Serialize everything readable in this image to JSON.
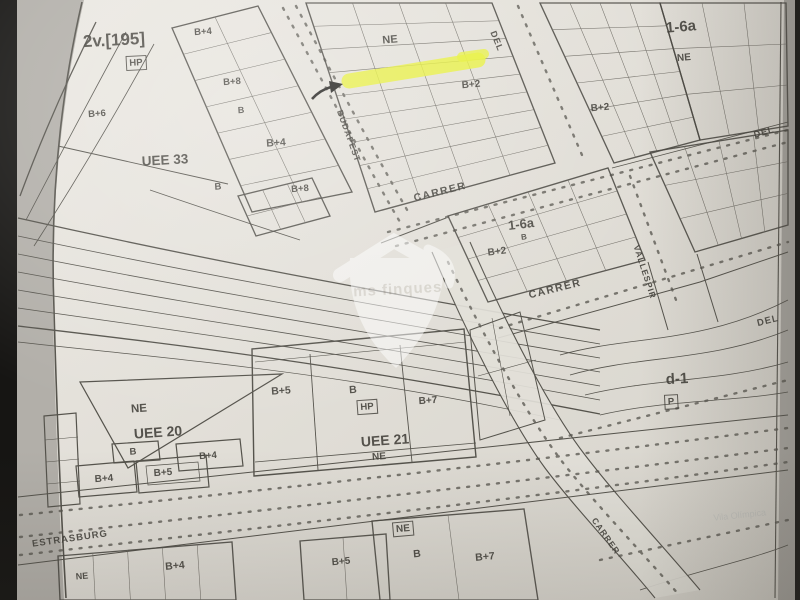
{
  "map": {
    "paper_color": "#e6e3dc",
    "ink_color": "#45433d",
    "highlight": {
      "color": "#e9f23c"
    },
    "watermark": {
      "text": "ms finques"
    },
    "faint_label": {
      "text": "Vila Olímpica"
    },
    "labels": [
      {
        "id": "zone-2v-195",
        "text": "2v.[195]",
        "x": 114,
        "y": 40,
        "rot": -3,
        "size": 17,
        "w": 700
      },
      {
        "id": "hp-box-nw",
        "text": "HP",
        "x": 136,
        "y": 63,
        "rot": -3,
        "size": 9.5,
        "w": 700,
        "boxed": true
      },
      {
        "id": "b4-nw-1",
        "text": "B+4",
        "x": 203,
        "y": 32,
        "rot": -4,
        "size": 9.5,
        "w": 700
      },
      {
        "id": "b8-nw",
        "text": "B+8",
        "x": 232,
        "y": 82,
        "rot": -4,
        "size": 9.5,
        "w": 700
      },
      {
        "id": "b6-w",
        "text": "B+6",
        "x": 97,
        "y": 114,
        "rot": -4,
        "size": 9.5,
        "w": 700
      },
      {
        "id": "b-nw-1",
        "text": "B",
        "x": 241,
        "y": 110,
        "rot": -4,
        "size": 9,
        "w": 700
      },
      {
        "id": "b4-nw-2",
        "text": "B+4",
        "x": 276,
        "y": 143,
        "rot": -4,
        "size": 10.5,
        "w": 700
      },
      {
        "id": "b-nw-2",
        "text": "B",
        "x": 218,
        "y": 187,
        "rot": -4,
        "size": 9.5,
        "w": 700
      },
      {
        "id": "b8-nw-2",
        "text": "B+8",
        "x": 300,
        "y": 189,
        "rot": -4,
        "size": 9.5,
        "w": 700
      },
      {
        "id": "zone-uee-33",
        "text": "UEE 33",
        "x": 165,
        "y": 160,
        "rot": -3,
        "size": 13.5,
        "w": 700
      },
      {
        "id": "ne-top-center",
        "text": "NE",
        "x": 390,
        "y": 40,
        "rot": -5,
        "size": 11,
        "w": 700
      },
      {
        "id": "street-del-top",
        "text": "DEL",
        "x": 497,
        "y": 41,
        "rot": 68,
        "size": 9,
        "w": 700,
        "ls": 1
      },
      {
        "id": "b2-top-center",
        "text": "B+2",
        "x": 471,
        "y": 85,
        "rot": -5,
        "size": 10,
        "w": 700
      },
      {
        "id": "street-budapest",
        "text": "BUDAPEST",
        "x": 349,
        "y": 136,
        "rot": 70,
        "size": 8.5,
        "w": 600,
        "ls": 1
      },
      {
        "id": "zone-1-6a-ne",
        "text": "1-6a",
        "x": 681,
        "y": 27,
        "rot": -5,
        "size": 15,
        "w": 700
      },
      {
        "id": "ne-top-right",
        "text": "NE",
        "x": 684,
        "y": 58,
        "rot": -5,
        "size": 10,
        "w": 700
      },
      {
        "id": "b2-top-right",
        "text": "B+2",
        "x": 600,
        "y": 108,
        "rot": -5,
        "size": 10,
        "w": 700
      },
      {
        "id": "street-del-topright",
        "text": "DEL",
        "x": 764,
        "y": 132,
        "rot": -16,
        "size": 9,
        "w": 700,
        "ls": 1
      },
      {
        "id": "street-carrer-1",
        "text": "CARRER",
        "x": 440,
        "y": 192,
        "rot": -14,
        "size": 10.5,
        "w": 700,
        "ls": 1.5
      },
      {
        "id": "zone-1-6a-center",
        "text": "1-6a",
        "x": 521,
        "y": 224,
        "rot": -7,
        "size": 13,
        "w": 700
      },
      {
        "id": "b-center",
        "text": "B",
        "x": 524,
        "y": 237,
        "rot": -7,
        "size": 8,
        "w": 700
      },
      {
        "id": "b2-center",
        "text": "B+2",
        "x": 497,
        "y": 252,
        "rot": -7,
        "size": 10,
        "w": 700
      },
      {
        "id": "street-carrer-2",
        "text": "CARRER",
        "x": 555,
        "y": 289,
        "rot": -14,
        "size": 10.5,
        "w": 700,
        "ls": 1.5
      },
      {
        "id": "street-vallespir",
        "text": "VALLESPIR",
        "x": 645,
        "y": 272,
        "rot": 72,
        "size": 8.5,
        "w": 600,
        "ls": 1
      },
      {
        "id": "street-del-right",
        "text": "DEL",
        "x": 768,
        "y": 321,
        "rot": -14,
        "size": 9.5,
        "w": 700,
        "ls": 1
      },
      {
        "id": "ne-uee20",
        "text": "NE",
        "x": 139,
        "y": 409,
        "rot": -4,
        "size": 11.5,
        "w": 700
      },
      {
        "id": "zone-uee-20",
        "text": "UEE 20",
        "x": 158,
        "y": 432,
        "rot": -4,
        "size": 14,
        "w": 700
      },
      {
        "id": "b-uee20",
        "text": "B",
        "x": 133,
        "y": 452,
        "rot": -4,
        "size": 9.5,
        "w": 700
      },
      {
        "id": "b4-uee20-1",
        "text": "B+4",
        "x": 208,
        "y": 456,
        "rot": -4,
        "size": 9.5,
        "w": 700
      },
      {
        "id": "b4-uee20-2",
        "text": "B+4",
        "x": 104,
        "y": 479,
        "rot": -4,
        "size": 10,
        "w": 700
      },
      {
        "id": "b5-uee20",
        "text": "B+5",
        "x": 163,
        "y": 473,
        "rot": -4,
        "size": 10,
        "w": 700
      },
      {
        "id": "b5-uee21",
        "text": "B+5",
        "x": 281,
        "y": 391,
        "rot": -4,
        "size": 10.5,
        "w": 700
      },
      {
        "id": "b-uee21",
        "text": "B",
        "x": 353,
        "y": 390,
        "rot": -4,
        "size": 10.5,
        "w": 700
      },
      {
        "id": "hp-box-uee21",
        "text": "HP",
        "x": 367,
        "y": 407,
        "rot": -4,
        "size": 9.5,
        "w": 700,
        "boxed": true
      },
      {
        "id": "b7-uee21",
        "text": "B+7",
        "x": 428,
        "y": 401,
        "rot": -4,
        "size": 10,
        "w": 700
      },
      {
        "id": "zone-uee-21",
        "text": "UEE 21",
        "x": 385,
        "y": 440,
        "rot": -4,
        "size": 14,
        "w": 700
      },
      {
        "id": "ne-uee21",
        "text": "NE",
        "x": 379,
        "y": 457,
        "rot": -4,
        "size": 10,
        "w": 700
      },
      {
        "id": "zone-d-1",
        "text": "d-1",
        "x": 677,
        "y": 379,
        "rot": -3,
        "size": 15,
        "w": 700
      },
      {
        "id": "p-box-d1",
        "text": "P",
        "x": 671,
        "y": 402,
        "rot": -3,
        "size": 9.5,
        "w": 700,
        "boxed": true
      },
      {
        "id": "street-estrasburg",
        "text": "ESTRASBURG",
        "x": 70,
        "y": 539,
        "rot": -8,
        "size": 9.5,
        "w": 600,
        "ls": 1
      },
      {
        "id": "b4-s",
        "text": "B+4",
        "x": 175,
        "y": 566,
        "rot": -5,
        "size": 10.5,
        "w": 700
      },
      {
        "id": "b5-s",
        "text": "B+5",
        "x": 341,
        "y": 562,
        "rot": -5,
        "size": 10,
        "w": 700
      },
      {
        "id": "ne-s-left",
        "text": "NE",
        "x": 82,
        "y": 576,
        "rot": -5,
        "size": 9,
        "w": 700
      },
      {
        "id": "ne-s-mid",
        "text": "NE",
        "x": 403,
        "y": 529,
        "rot": -5,
        "size": 10,
        "w": 700,
        "boxed": true
      },
      {
        "id": "b-s",
        "text": "B",
        "x": 417,
        "y": 554,
        "rot": -5,
        "size": 10.5,
        "w": 700
      },
      {
        "id": "b7-s",
        "text": "B+7",
        "x": 485,
        "y": 557,
        "rot": -5,
        "size": 10.5,
        "w": 700
      },
      {
        "id": "street-carrer-s",
        "text": "CARRER",
        "x": 606,
        "y": 536,
        "rot": 55,
        "size": 8.5,
        "w": 600,
        "ls": 1
      }
    ],
    "blocks": [
      {
        "name": "block-nw",
        "quad": [
          [
            172,
            28
          ],
          [
            258,
            6
          ],
          [
            352,
            192
          ],
          [
            252,
            212
          ]
        ],
        "cols": 2,
        "rows": 7
      },
      {
        "name": "block-budapest-east",
        "quad": [
          [
            306,
            3
          ],
          [
            492,
            3
          ],
          [
            555,
            163
          ],
          [
            375,
            212
          ]
        ],
        "cols": 4,
        "rows": 9
      },
      {
        "name": "block-ne-dense",
        "quad": [
          [
            540,
            3
          ],
          [
            660,
            3
          ],
          [
            700,
            140
          ],
          [
            614,
            163
          ]
        ],
        "cols": 4,
        "rows": 6
      },
      {
        "name": "block-ne-open",
        "quad": [
          [
            660,
            3
          ],
          [
            786,
            3
          ],
          [
            788,
            126
          ],
          [
            700,
            140
          ]
        ],
        "cols": 3,
        "rows": 3
      },
      {
        "name": "block-center-1-6a",
        "quad": [
          [
            448,
            216
          ],
          [
            608,
            168
          ],
          [
            645,
            260
          ],
          [
            488,
            302
          ]
        ],
        "cols": 4,
        "rows": 4
      },
      {
        "name": "block-vallespir-east",
        "quad": [
          [
            650,
            152
          ],
          [
            788,
            130
          ],
          [
            788,
            225
          ],
          [
            695,
            252
          ]
        ],
        "cols": 4,
        "rows": 3
      },
      {
        "name": "block-uee33-east",
        "quad": [
          [
            238,
            196
          ],
          [
            312,
            178
          ],
          [
            330,
            216
          ],
          [
            256,
            236
          ]
        ],
        "cols": 3,
        "rows": 2
      },
      {
        "name": "strip-sw",
        "quad": [
          [
            58,
            556
          ],
          [
            232,
            542
          ],
          [
            236,
            600
          ],
          [
            60,
            600
          ]
        ],
        "cols": 5,
        "rows": 1
      },
      {
        "name": "strip-s-mid",
        "quad": [
          [
            300,
            541
          ],
          [
            386,
            534
          ],
          [
            390,
            600
          ],
          [
            304,
            600
          ]
        ],
        "cols": 2,
        "rows": 1
      },
      {
        "name": "strip-s-east",
        "quad": [
          [
            372,
            521
          ],
          [
            524,
            509
          ],
          [
            538,
            600
          ],
          [
            380,
            600
          ]
        ],
        "cols": 2,
        "rows": 1
      }
    ]
  }
}
